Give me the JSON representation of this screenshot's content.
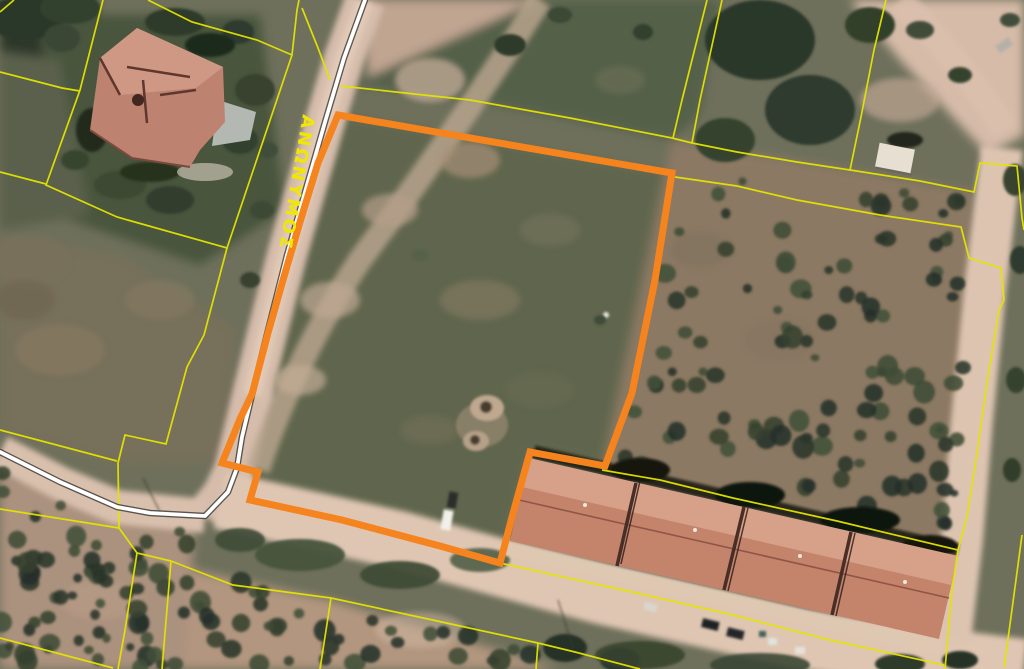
{
  "map_view": {
    "type": "aerial-cadastral-map",
    "road_label": "ΑΝΩΝΥΜΟΣ",
    "colors": {
      "highlight_parcel": "#f5831e",
      "cadastral_line": "#e4e400",
      "road_centerline": "#ffffff",
      "road_casing": "#2f2f2d",
      "road_label_text": "#f0e800"
    }
  }
}
